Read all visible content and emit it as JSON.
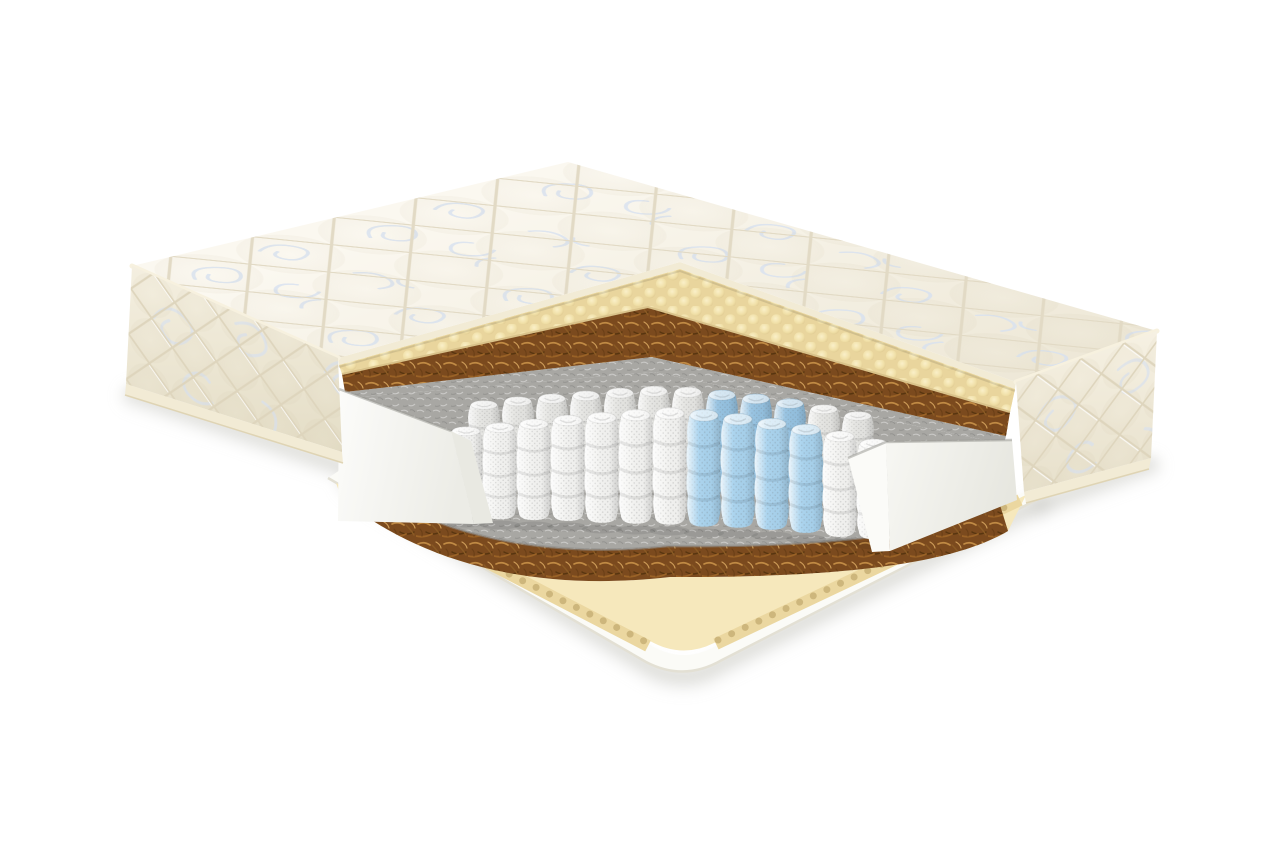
{
  "scene": {
    "subject": "orthopedic pocket-spring mattress with layered corner cutaway",
    "view": "three-quarter product render on white background",
    "background": "#ffffff"
  },
  "colors": {
    "cover_base": "#F6F2E7",
    "cover_shade": "#E9E2CF",
    "quilt_line": "#E2DAC5",
    "floral": "#D7E1F0",
    "tape": "#F2EBD5",
    "tape_edge": "#DFD4B4",
    "foam_yellow": "#F2E2AC",
    "foam_bump_hi": "#FAF0CA",
    "foam_bump_sh": "#D9C28A",
    "coir": "#7B4A1E",
    "coir_hi": "#C08A44",
    "coir_mid": "#9A6226",
    "coir_dark": "#58350F",
    "felt": "#A8A7A3",
    "felt_hi": "#C9C8C4",
    "felt_dark": "#8C8B87",
    "spring_white": "#F4F4F2",
    "spring_blue": "#A9D3EE",
    "spring_back_white": "#E6E6E3",
    "spring_back_blue": "#95C2E1",
    "wedge_white": "#FBFBF8",
    "wedge_shade": "#E9E9E2",
    "base_foam": "#F6E8BC",
    "base_foam_edge": "#EBD7A0",
    "scallop": "#CDB67C",
    "bottom_cover": "#FBFBF7",
    "shadow": "#CFCFCA"
  },
  "layers": [
    {
      "name": "quilted-cover",
      "label": "Quilted cover with floral stitching",
      "color": "#F6F2E7"
    },
    {
      "name": "comfort-foam",
      "label": "Egg-crate comfort foam",
      "color": "#F2E2AC"
    },
    {
      "name": "coir-top",
      "label": "Coconut coir plate",
      "color": "#7B4A1E"
    },
    {
      "name": "felt-top",
      "label": "Felt pad",
      "color": "#A8A7A3"
    },
    {
      "name": "pocket-springs",
      "label": "Independent pocket springs",
      "color": "#F4F4F2"
    },
    {
      "name": "zone-springs",
      "label": "Reinforced zone springs",
      "color": "#A9D3EE"
    },
    {
      "name": "foam-encasement",
      "label": "Foam side encasement",
      "color": "#FBFBF8"
    },
    {
      "name": "felt-bottom",
      "label": "Felt pad",
      "color": "#A8A7A3"
    },
    {
      "name": "coir-bottom",
      "label": "Coconut coir plate",
      "color": "#7B4A1E"
    },
    {
      "name": "base-foam",
      "label": "Egg-crate base foam",
      "color": "#F6E8BC"
    },
    {
      "name": "bottom-cover",
      "label": "Bottom cover",
      "color": "#FBFBF7"
    }
  ],
  "springs": {
    "front": [
      [
        466,
        424,
        96,
        "w"
      ],
      [
        500,
        420,
        102,
        "w"
      ],
      [
        534,
        416,
        107,
        "w"
      ],
      [
        568,
        412,
        112,
        "w"
      ],
      [
        602,
        409,
        117,
        "w"
      ],
      [
        636,
        406,
        121,
        "w"
      ],
      [
        670,
        404,
        124,
        "w"
      ],
      [
        704,
        406,
        124,
        "b"
      ],
      [
        738,
        410,
        121,
        "b"
      ],
      [
        772,
        415,
        118,
        "b"
      ],
      [
        806,
        421,
        115,
        "b"
      ],
      [
        840,
        428,
        112,
        "w"
      ],
      [
        874,
        436,
        106,
        "w"
      ]
    ],
    "back": [
      [
        484,
        398,
        92,
        "w"
      ],
      [
        518,
        394,
        97,
        "w"
      ],
      [
        552,
        391,
        101,
        "w"
      ],
      [
        586,
        388,
        104,
        "w"
      ],
      [
        620,
        385,
        107,
        "w"
      ],
      [
        654,
        383,
        109,
        "w"
      ],
      [
        688,
        384,
        109,
        "w"
      ],
      [
        722,
        387,
        107,
        "b"
      ],
      [
        756,
        391,
        104,
        "b"
      ],
      [
        790,
        396,
        100,
        "b"
      ],
      [
        824,
        402,
        96,
        "w"
      ],
      [
        858,
        409,
        92,
        "w"
      ]
    ]
  }
}
